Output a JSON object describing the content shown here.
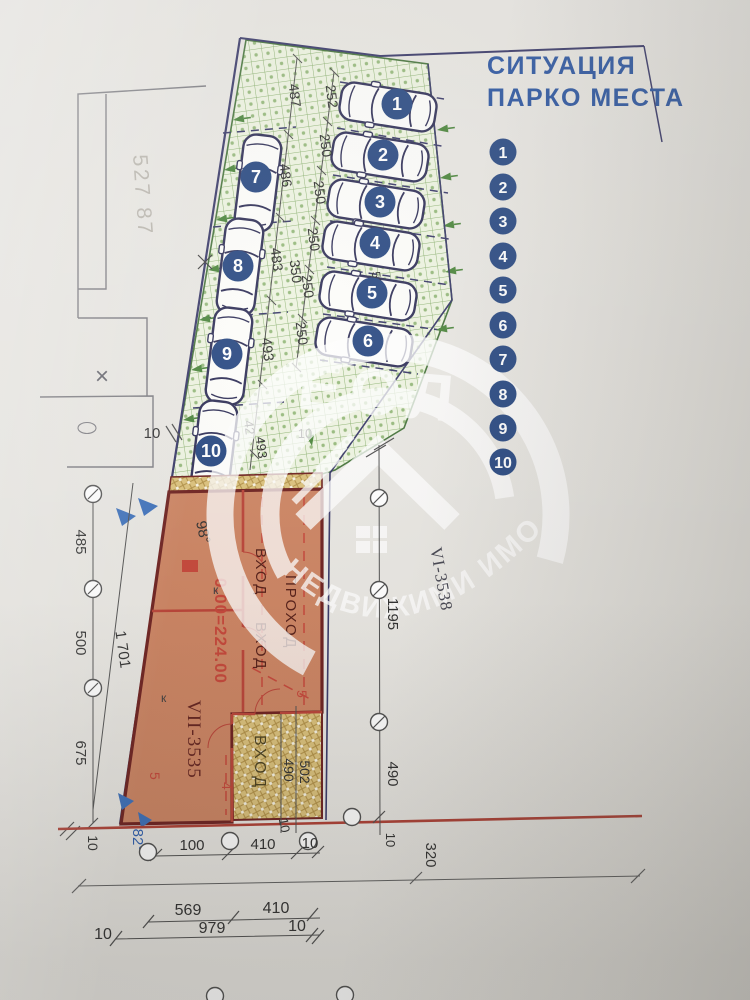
{
  "title": {
    "line1": "СИТУАЦИЯ",
    "line2": "ПАРКО МЕСТА"
  },
  "legend": {
    "numbers": [
      "1",
      "2",
      "3",
      "4",
      "5",
      "6",
      "7",
      "8",
      "9",
      "10"
    ]
  },
  "parking": {
    "badges": [
      "1",
      "2",
      "3",
      "4",
      "5",
      "6",
      "7",
      "8",
      "9",
      "10"
    ]
  },
  "plot": {
    "survey_ref": "527 87",
    "x_mark": "×",
    "angle_top": "98°",
    "angle_bottom": "82°",
    "k_upper": "к",
    "k_lower": "к",
    "number_main": "VII-3535",
    "number_adjacent": "VI-3538",
    "level_mark": "0.00=224.00"
  },
  "rooms": {
    "entrance_upper": "ВХОД",
    "entrance_lower": "ВХОД",
    "entrance_outdoor": "ВХОД",
    "passage": "ПРОХОД",
    "setback_right": "5",
    "setback_left": "5",
    "setback_bottom": "4"
  },
  "dim": {
    "c487": "487",
    "c486": "486",
    "c483": "483",
    "c493a": "493",
    "c350": "350",
    "b252": "252",
    "b250a": "250",
    "b250b": "250",
    "b250c": "250",
    "b250d": "250",
    "b250e": "250",
    "c525": "525",
    "c42": "42",
    "c493b": "493",
    "t10a": "10",
    "t10b": "10",
    "l485": "485",
    "l500": "500",
    "l675": "675",
    "l1701": "1 701",
    "r1195": "1195",
    "r490": "490",
    "y502": "502",
    "y490": "490",
    "bl10": "10",
    "bt100": "100",
    "bt410": "410",
    "bt10": "10",
    "bm10": "10",
    "br10": "10",
    "b320": "320",
    "bb569": "569",
    "bb410": "410",
    "bb10l": "10",
    "bb979": "979",
    "bb10r": "10"
  },
  "watermark": {
    "letters": "ЕОЛ",
    "arc_text": "НЕДВИЖИМИ ИМОТИ"
  },
  "colors": {
    "title_blue": "#1d4a9a",
    "badge_navy": "#1b3d7a",
    "boundary_navy": "#2b2b5e",
    "green_fill": "#edf3df",
    "green_line": "#85ad68",
    "orange_fill": "#c97c58",
    "wall_maroon": "#641210",
    "red_line": "#b5372a",
    "yellow_fill": "#d9bd72",
    "base_red": "#a93226",
    "arrow_blue": "#2f66b5",
    "dim_dark": "#3a3a3a"
  }
}
